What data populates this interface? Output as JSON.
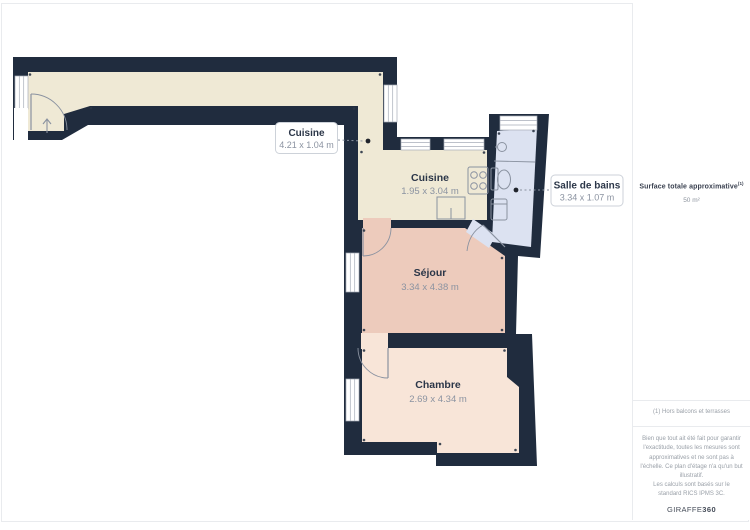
{
  "plan": {
    "colors": {
      "wall": "#202c3e",
      "kitchen_corridor_floor": "#efe9d5",
      "sejour_floor": "#edcbbc",
      "chambre_floor": "#f8e5d8",
      "bathroom_floor": "#dce2f1",
      "fixture_stroke": "#8a92a0",
      "label_box_border": "#cdd2d9"
    },
    "rooms": [
      {
        "name": "Cuisine",
        "dims": "4.21 x 1.04 m",
        "label_style": "boxed"
      },
      {
        "name": "Cuisine",
        "dims": "1.95 x 3.04 m",
        "label_style": "plain"
      },
      {
        "name": "Salle de bains",
        "dims": "3.34 x 1.07 m",
        "label_style": "boxed"
      },
      {
        "name": "Séjour",
        "dims": "3.34 x 4.38 m",
        "label_style": "plain"
      },
      {
        "name": "Chambre",
        "dims": "2.69 x 4.34 m",
        "label_style": "plain"
      }
    ],
    "icons": [
      "entrance-arrow",
      "door-swing",
      "window",
      "stove",
      "kitchen-sink",
      "bathroom-sink",
      "toilet",
      "washing-machine"
    ]
  },
  "sidebar": {
    "surface_title": "Surface totale approximative",
    "surface_title_sup": "(1)",
    "surface_value": "50 m²",
    "footnote": "(1) Hors balcons et terrasses",
    "disclaimer": "Bien que tout ait été fait pour garantir l'exactitude, toutes les mesures sont approximatives et ne sont pas à l'échelle. Ce plan d'étage n'a qu'un but illustratif.",
    "standard": "Les calculs sont basés sur le standard RICS IPMS 3C.",
    "brand_name": "GIRAFFE",
    "brand_suffix": "360"
  }
}
